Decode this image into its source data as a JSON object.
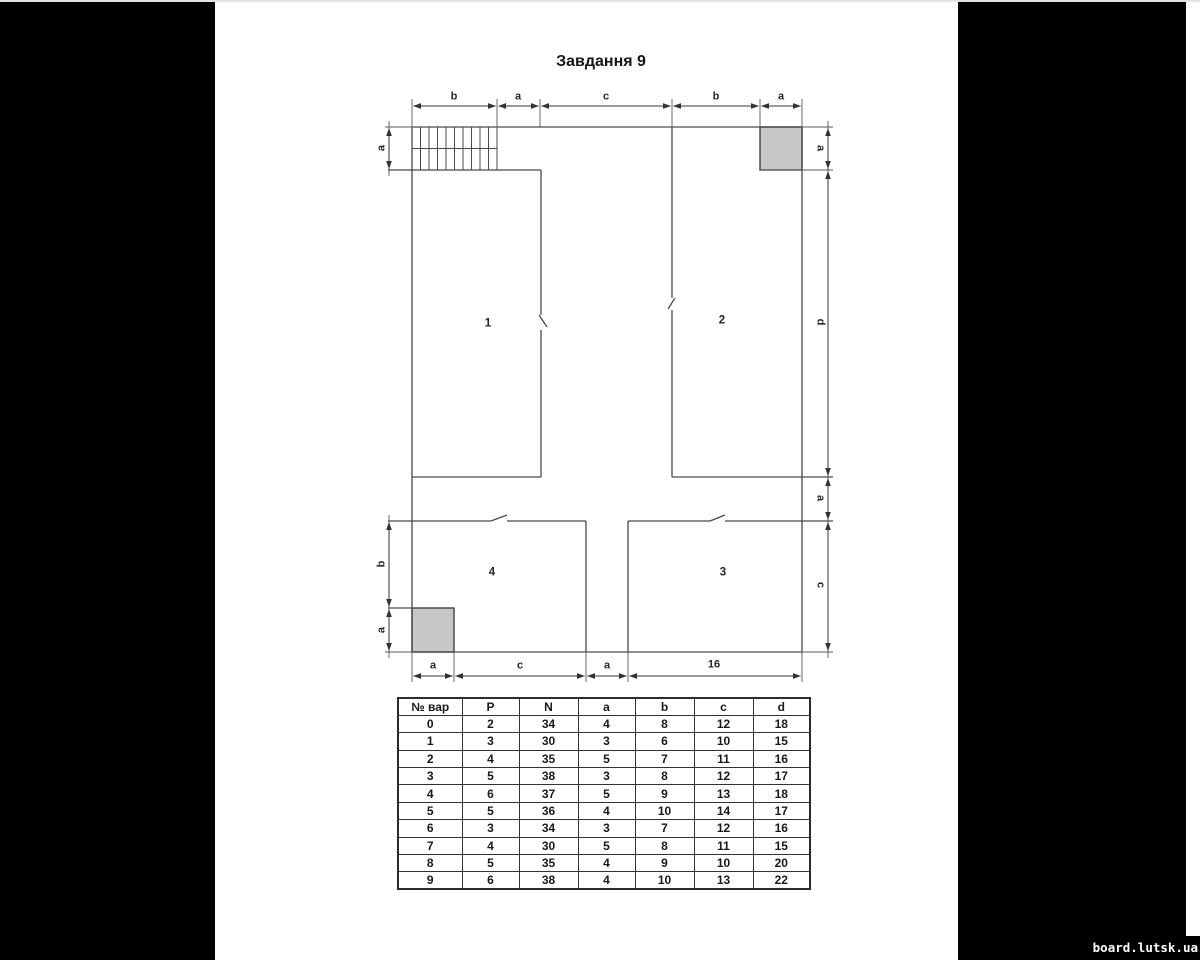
{
  "page": {
    "title": "Завдання 9",
    "watermark": "board.lutsk.ua"
  },
  "drawing": {
    "top_dims": [
      "b",
      "a",
      "c",
      "b",
      "a"
    ],
    "bottom_dims": [
      "a",
      "c",
      "a",
      "16"
    ],
    "left_top_dims": [
      "a"
    ],
    "left_bottom_dims": [
      "b",
      "a"
    ],
    "right_dims": [
      "a",
      "d",
      "a",
      "c"
    ],
    "rooms": {
      "r1": "1",
      "r2": "2",
      "r3": "3",
      "r4": "4"
    }
  },
  "table": {
    "headers": [
      "№ вар",
      "P",
      "N",
      "a",
      "b",
      "c",
      "d"
    ],
    "rows": [
      [
        "0",
        "2",
        "34",
        "4",
        "8",
        "12",
        "18"
      ],
      [
        "1",
        "3",
        "30",
        "3",
        "6",
        "10",
        "15"
      ],
      [
        "2",
        "4",
        "35",
        "5",
        "7",
        "11",
        "16"
      ],
      [
        "3",
        "5",
        "38",
        "3",
        "8",
        "12",
        "17"
      ],
      [
        "4",
        "6",
        "37",
        "5",
        "9",
        "13",
        "18"
      ],
      [
        "5",
        "5",
        "36",
        "4",
        "10",
        "14",
        "17"
      ],
      [
        "6",
        "3",
        "34",
        "3",
        "7",
        "12",
        "16"
      ],
      [
        "7",
        "4",
        "30",
        "5",
        "8",
        "11",
        "15"
      ],
      [
        "8",
        "5",
        "35",
        "4",
        "9",
        "10",
        "20"
      ],
      [
        "9",
        "6",
        "38",
        "4",
        "10",
        "13",
        "22"
      ]
    ]
  }
}
